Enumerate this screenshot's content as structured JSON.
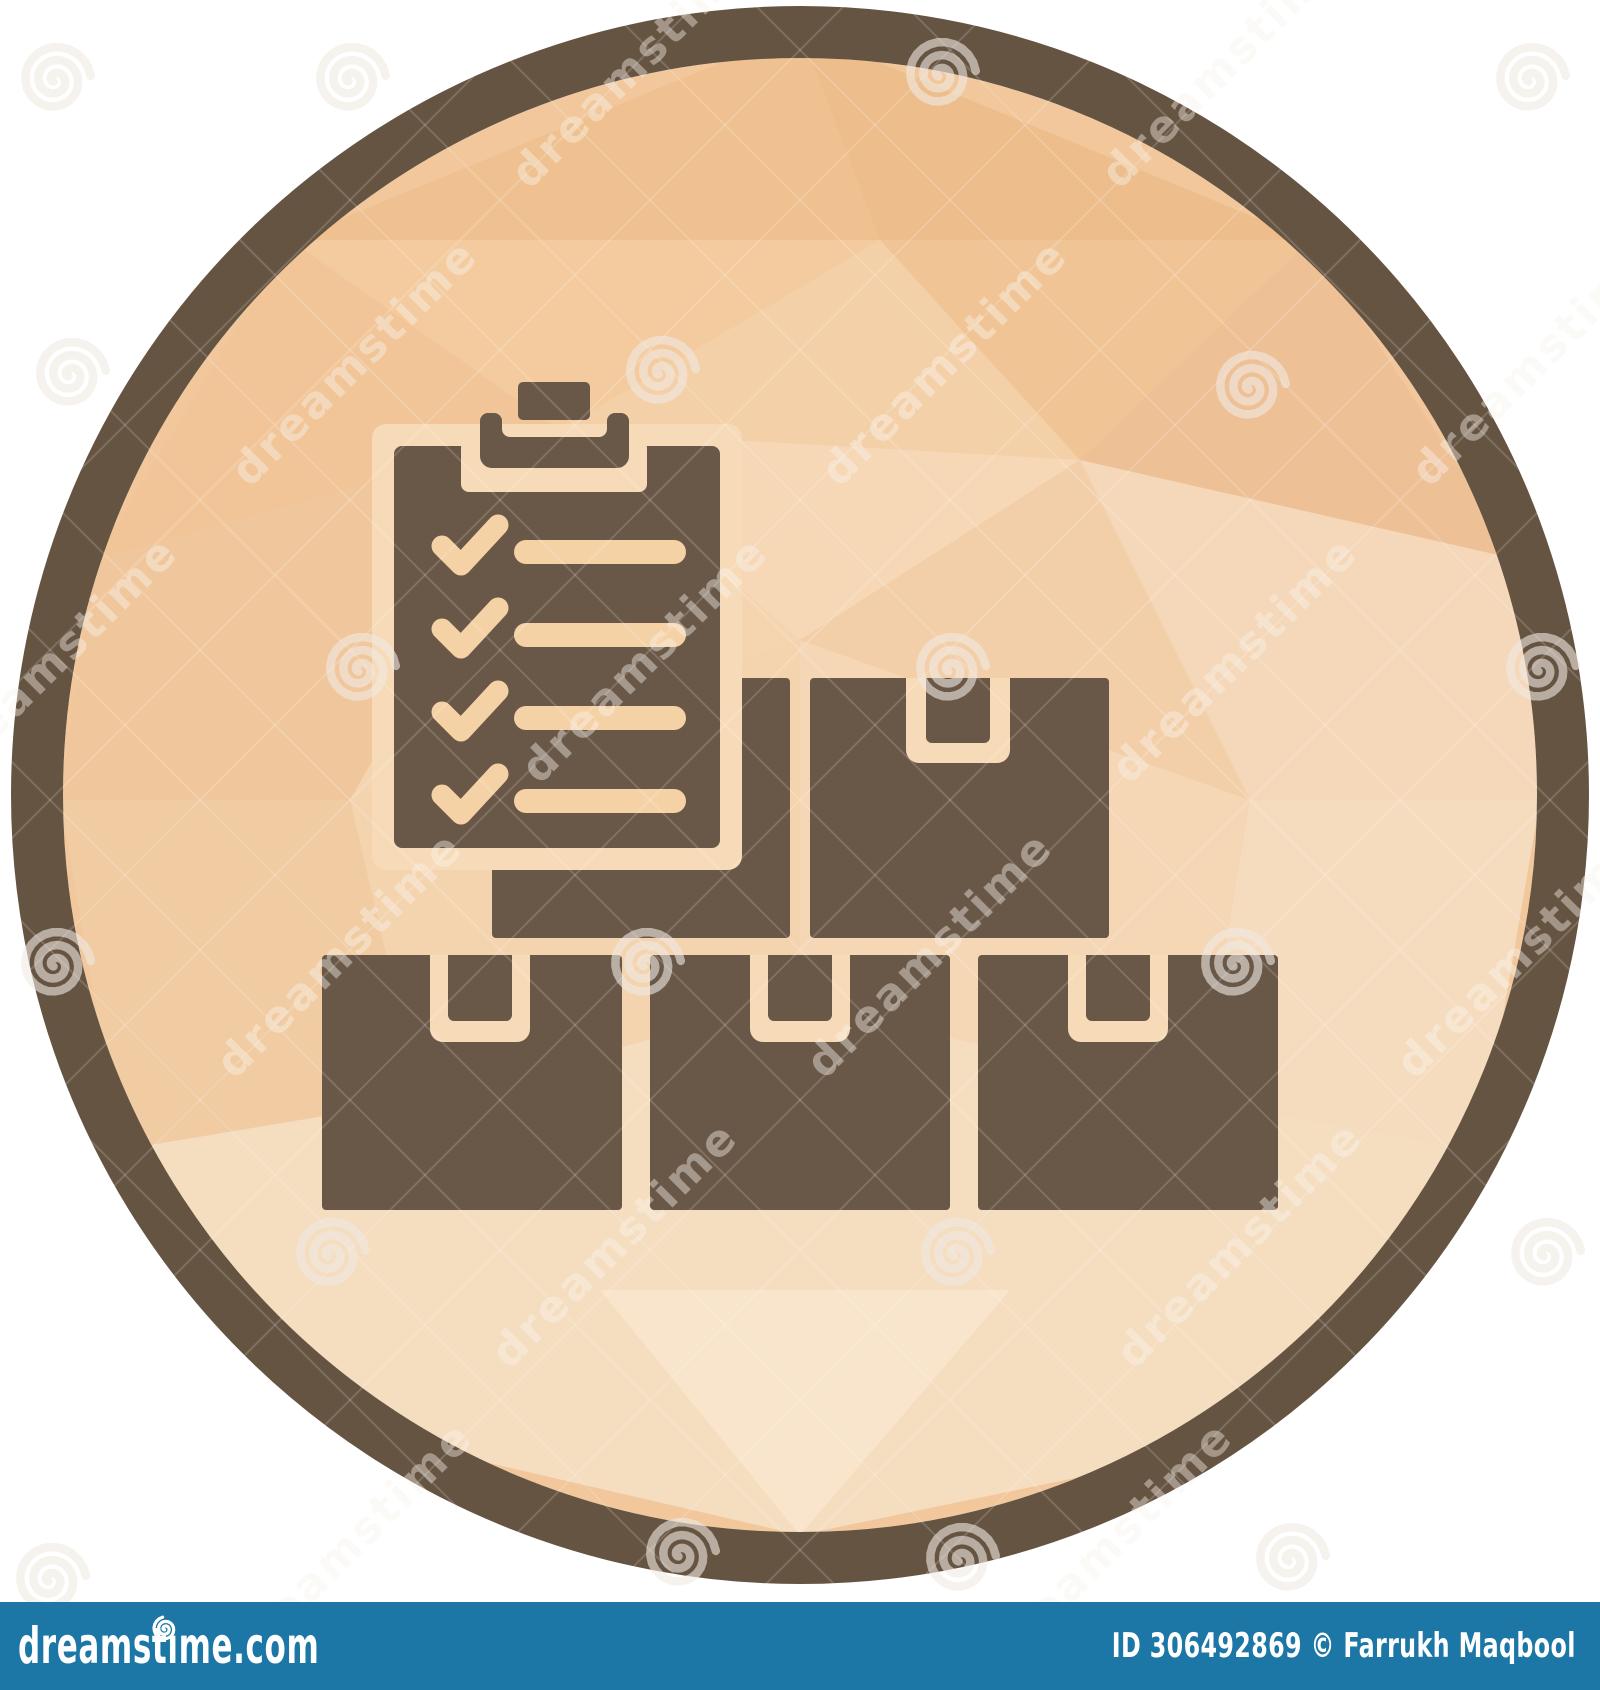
{
  "page": {
    "bg": "#ffffff"
  },
  "icon": {
    "name": "inventory-checklist-with-parcel-boxes",
    "ring_color": "#665442",
    "glyph_color": "#695747",
    "cream": "#f7dbb8",
    "accent_cream": "#f5d1a6",
    "base_fill": "#f1c79b",
    "facets": [
      {
        "p": "800,30 290,240 880,240",
        "c": "#efc190"
      },
      {
        "p": "800,30 880,240 1310,240",
        "c": "#edbd8c"
      },
      {
        "p": "290,240 95,560 560,430",
        "c": "#f1c598"
      },
      {
        "p": "290,240 880,240 560,430",
        "c": "#f3cb9f"
      },
      {
        "p": "880,240 1310,240 1080,460",
        "c": "#f0c495"
      },
      {
        "p": "880,240 560,430 1080,460",
        "c": "#f4d0a8"
      },
      {
        "p": "1310,240 1520,560 1080,460",
        "c": "#eec096"
      },
      {
        "p": "95,560 60,800 350,800 560,430",
        "c": "#f0c79c"
      },
      {
        "p": "560,430 350,800 800,640",
        "c": "#f5d4b0"
      },
      {
        "p": "560,430 800,640 1080,460",
        "c": "#f6d8b7"
      },
      {
        "p": "1080,460 800,640 1250,800",
        "c": "#f3cfa9"
      },
      {
        "p": "1080,460 1250,800 1540,800 1520,560",
        "c": "#f5d8b9"
      },
      {
        "p": "60,800 120,1150 420,1100 350,800",
        "c": "#f1cba2"
      },
      {
        "p": "350,800 420,1100 800,1000 800,640",
        "c": "#f4d3af"
      },
      {
        "p": "800,640 1250,800 1200,1100 800,1000",
        "c": "#f5d6b5"
      },
      {
        "p": "1250,800 1540,800 1480,1150 1200,1100",
        "c": "#f6dcbf"
      },
      {
        "p": "120,1150 420,1100 800,1000 1200,1100 1480,1150 1210,1450 800,1535 390,1440",
        "c": "#f5ddc0"
      },
      {
        "p": "800,1535 600,1290 1010,1290",
        "c": "#f8e5cb"
      }
    ]
  },
  "watermark": {
    "label": "dreamstime",
    "mark_color": "rgba(240,234,226,0.60)",
    "text_color": "rgba(248,243,237,0.42)",
    "line_color": "rgba(255,255,255,0.16)",
    "spirals": [
      [
        55,
        80
      ],
      [
        350,
        80
      ],
      [
        940,
        75
      ],
      [
        1530,
        80
      ],
      [
        70,
        375
      ],
      [
        660,
        373
      ],
      [
        1250,
        388
      ],
      [
        360,
        670
      ],
      [
        950,
        670
      ],
      [
        1540,
        670
      ],
      [
        55,
        965
      ],
      [
        645,
        965
      ],
      [
        1235,
        965
      ],
      [
        330,
        1255
      ],
      [
        955,
        1255
      ],
      [
        1545,
        1255
      ],
      [
        50,
        1580
      ],
      [
        680,
        1555
      ],
      [
        960,
        1560
      ],
      [
        1290,
        1560
      ]
    ],
    "texts": [
      [
        645,
        75
      ],
      [
        1235,
        75
      ],
      [
        365,
        373
      ],
      [
        955,
        373
      ],
      [
        1545,
        373
      ],
      [
        65,
        670
      ],
      [
        655,
        670
      ],
      [
        1245,
        670
      ],
      [
        350,
        965
      ],
      [
        940,
        965
      ],
      [
        1530,
        965
      ],
      [
        625,
        1255
      ],
      [
        1250,
        1255
      ],
      [
        360,
        1555
      ],
      [
        1120,
        1555
      ]
    ]
  },
  "footer": {
    "bg": "#1c77a6",
    "logo": "dreamstime.com",
    "credit": "ID 306492869 © Farrukh Maqbool",
    "text_color": "#ffffff"
  }
}
